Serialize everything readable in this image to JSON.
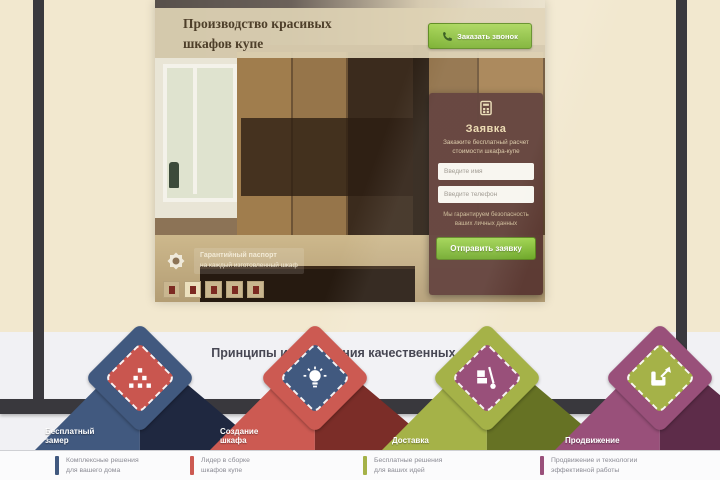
{
  "hero": {
    "title_line1": "Производство красивых",
    "title_line2": "шкафов купе",
    "call_button_label": "Заказать звонок",
    "guarantee_line1": "Гарантийный паспорт",
    "guarantee_line2": "на каждый изготовленный шкаф"
  },
  "form": {
    "title": "Заявка",
    "subtitle_line1": "Закажите бесплатный расчет",
    "subtitle_line2": "стоимости шкафа-купе",
    "name_placeholder": "Введите имя",
    "phone_placeholder": "Введите телефон",
    "note_line1": "Мы гарантируем безопасность",
    "note_line2": "ваших личных данных",
    "submit_label": "Отправить заявку"
  },
  "process": {
    "heading": "Принципы изготовления качественных шкафов"
  },
  "steps": [
    {
      "label_line1": "Бесплатный",
      "label_line2": "замер",
      "color": "#41597f",
      "inner": "#c9564f",
      "shade": "#1f2840",
      "icon": "pyramid-icon"
    },
    {
      "label_line1": "Создание",
      "label_line2": "шкафа",
      "color": "#cc5a52",
      "inner": "#41597f",
      "shade": "#7b2d28",
      "icon": "lightbulb-icon"
    },
    {
      "label_line1": "Доставка",
      "label_line2": "",
      "color": "#a5b248",
      "inner": "#99507a",
      "shade": "#667224",
      "icon": "handtruck-icon"
    },
    {
      "label_line1": "Продвижение",
      "label_line2": "",
      "color": "#99507a",
      "inner": "#a5b248",
      "shade": "#5d2c49",
      "icon": "armchair-icon"
    }
  ],
  "features": [
    {
      "color": "#41597f",
      "line1": "Комплексные решения",
      "line2": "для вашего дома"
    },
    {
      "color": "#cc5a52",
      "line1": "Лидер в сборке",
      "line2": "шкафов купе"
    },
    {
      "color": "#a5b248",
      "line1": "Бесплатные решения",
      "line2": "для ваших идей"
    },
    {
      "color": "#99507a",
      "line1": "Продвижение и технологии",
      "line2": "эффективной работы"
    }
  ],
  "colors": {
    "page_cream": "#f2e8cf",
    "monitor_frame": "#39383d",
    "accent_green": "#7cb132",
    "form_maroon": "#5a3832"
  }
}
